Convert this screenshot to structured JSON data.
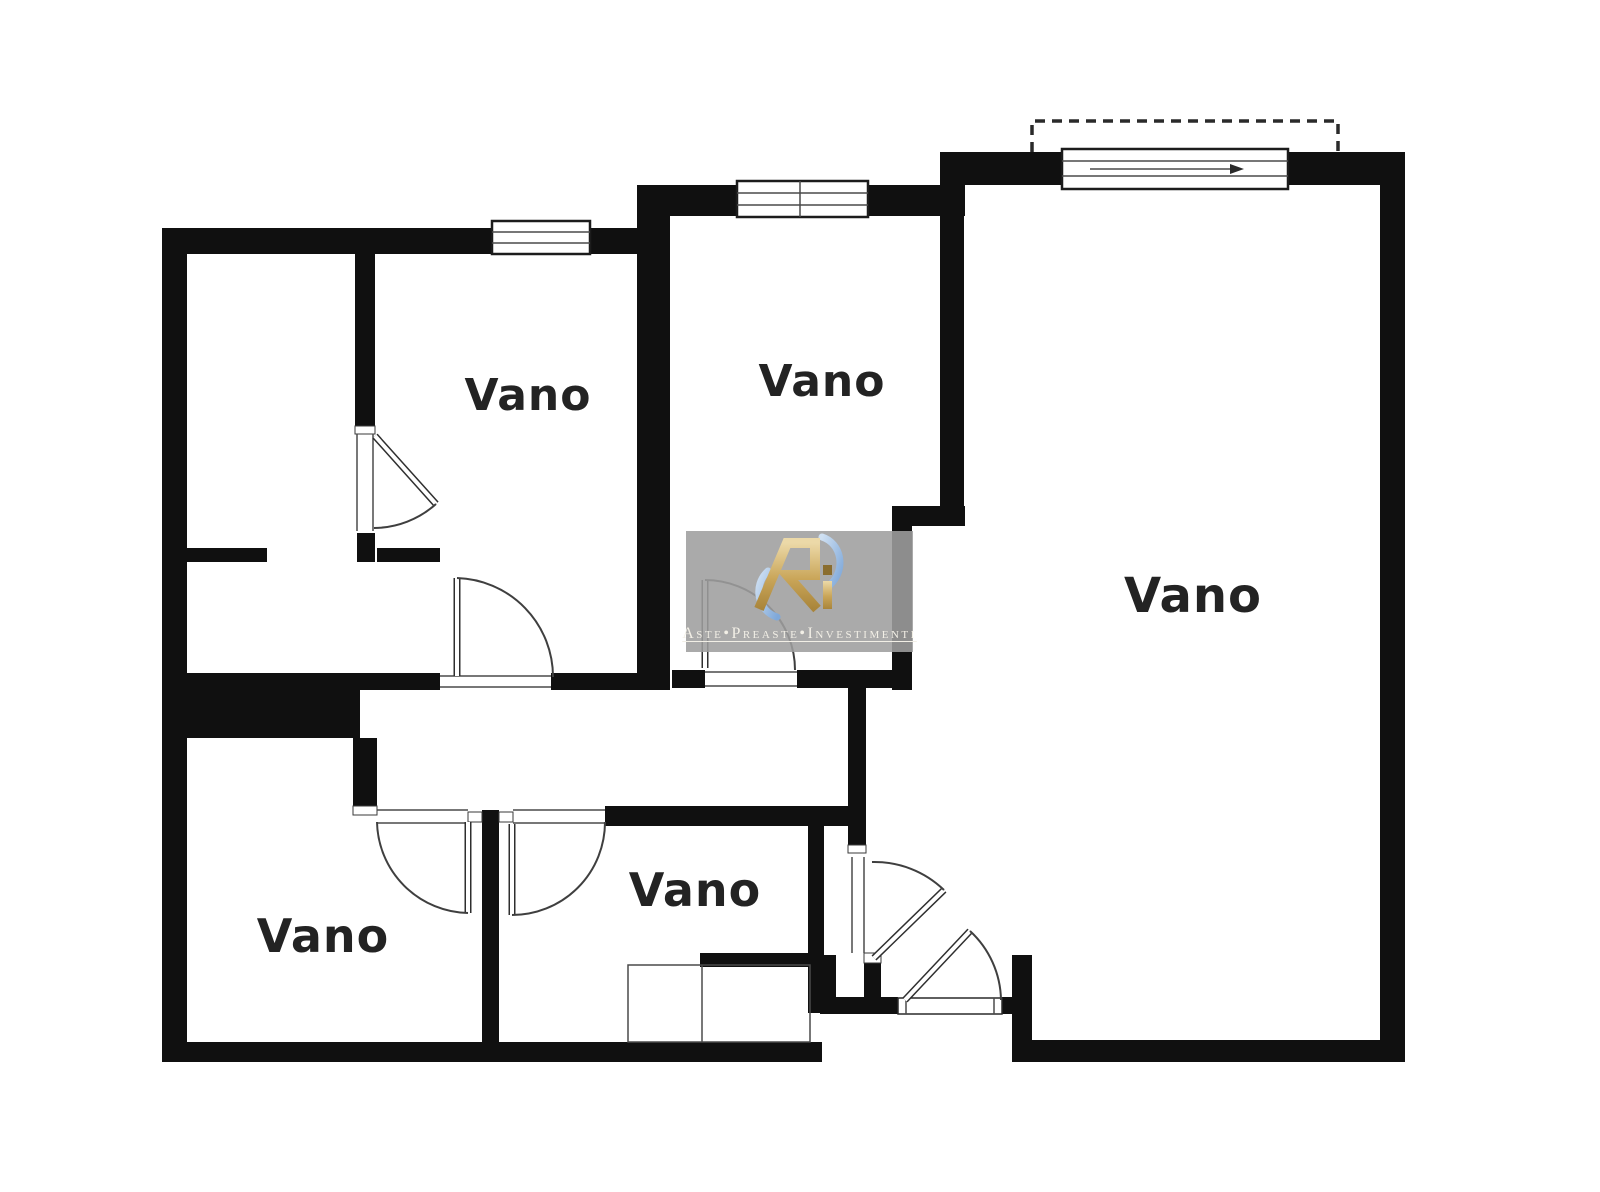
{
  "page": {
    "background": "#ffffff",
    "kind": "floor-plan"
  },
  "rooms": [
    {
      "id": "room-top-left-vano",
      "label": "Vano"
    },
    {
      "id": "room-top-middle-vano",
      "label": "Vano"
    },
    {
      "id": "room-right-vano",
      "label": "Vano"
    },
    {
      "id": "room-bottom-left-vano",
      "label": "Vano"
    },
    {
      "id": "room-bottom-middle-vano",
      "label": "Vano"
    }
  ],
  "watermark": {
    "brand_text": "Aste•Preaste•Investimenti",
    "monogram": "Ri"
  },
  "colors": {
    "wall": "#101010",
    "line": "#3a3a3a",
    "label": "#232323",
    "watermark_box": "#9e9e9e",
    "watermark_gold": "#c9a558",
    "watermark_gold_dark": "#8a6d2f",
    "watermark_blue": "#9dbfe6",
    "watermark_text": "#f2efe6"
  }
}
